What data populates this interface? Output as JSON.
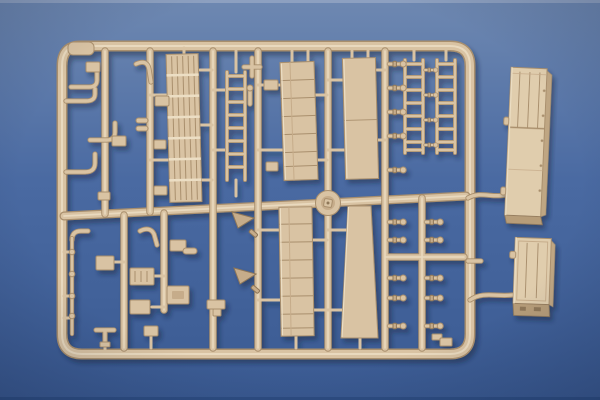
{
  "scene": {
    "type": "photograph",
    "description": "Tan plastic model-kit sprue (injection-molded parts frame) with two detached van-box parts, lying on a blue background",
    "colors": {
      "bg-top": "#6e88b1",
      "bg-mid": "#4a6aa2",
      "bg-bottom": "#3a5a92",
      "bg-top-strip": "#8da0c0",
      "bg-bottom-strip": "#2e4e84",
      "tan": "#d9c3a3",
      "tan-light": "#ecdec4",
      "tan-mid": "#c6ac8a",
      "tan-dark": "#a98f6d",
      "tan-deep": "#8f7758",
      "box-top": "#e0cdad",
      "box-side": "#bfa683",
      "box-front": "#b79d79",
      "shadow": "#16223c"
    },
    "parts_visible": [
      "rounded-rectangular-sprue-frame",
      "internal-runner-grid",
      "round-center-hub",
      "slatted-grating-panel",
      "long-access-ladder",
      "two-ladder-rail-parts-top-right",
      "ribbed-deck-panel-upper",
      "plain-deck-panel-upper",
      "ribbed-deck-panel-lower",
      "plain-deck-panel-lower",
      "curved-exhaust-pipe-parts",
      "tow-hook-parts",
      "thin-rod-part-with-collars",
      "small-axle-pins-with-round-heads",
      "anchor-shaped-bracket-parts",
      "assorted-small-blocks-and-cylinders",
      "detached-box-body-part-upper-right",
      "detached-box-body-part-lower-right",
      "sprue-gate-stubs"
    ]
  }
}
